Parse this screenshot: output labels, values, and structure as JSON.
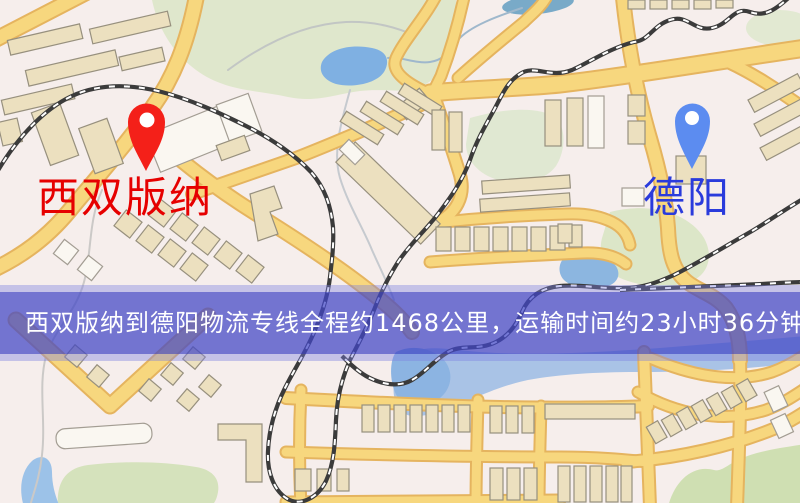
{
  "window": {
    "width": 800,
    "height": 503
  },
  "map": {
    "origin": {
      "label": "西双版纳",
      "pin_color": "#f42019",
      "label_color": "#e60000",
      "pin_icon": "map-pin"
    },
    "destination": {
      "label": "德阳",
      "pin_color": "#5c8cf0",
      "label_color": "#2a3bdc",
      "pin_icon": "map-pin"
    },
    "palette": {
      "background": "#f6eeec",
      "road": "#f7d77e",
      "building": "#ece0bf",
      "park": "#dfe7cc",
      "water": "#7fb0e2",
      "railway": "#3b3b3b"
    }
  },
  "banner": {
    "text": "西双版纳到德阳物流专线全程约1468公里，运输时间约23小时36分钟.",
    "distance": "1468公里",
    "duration": "23小时36分钟",
    "background": "#5a5ec8",
    "text_color": "#ffffff"
  }
}
